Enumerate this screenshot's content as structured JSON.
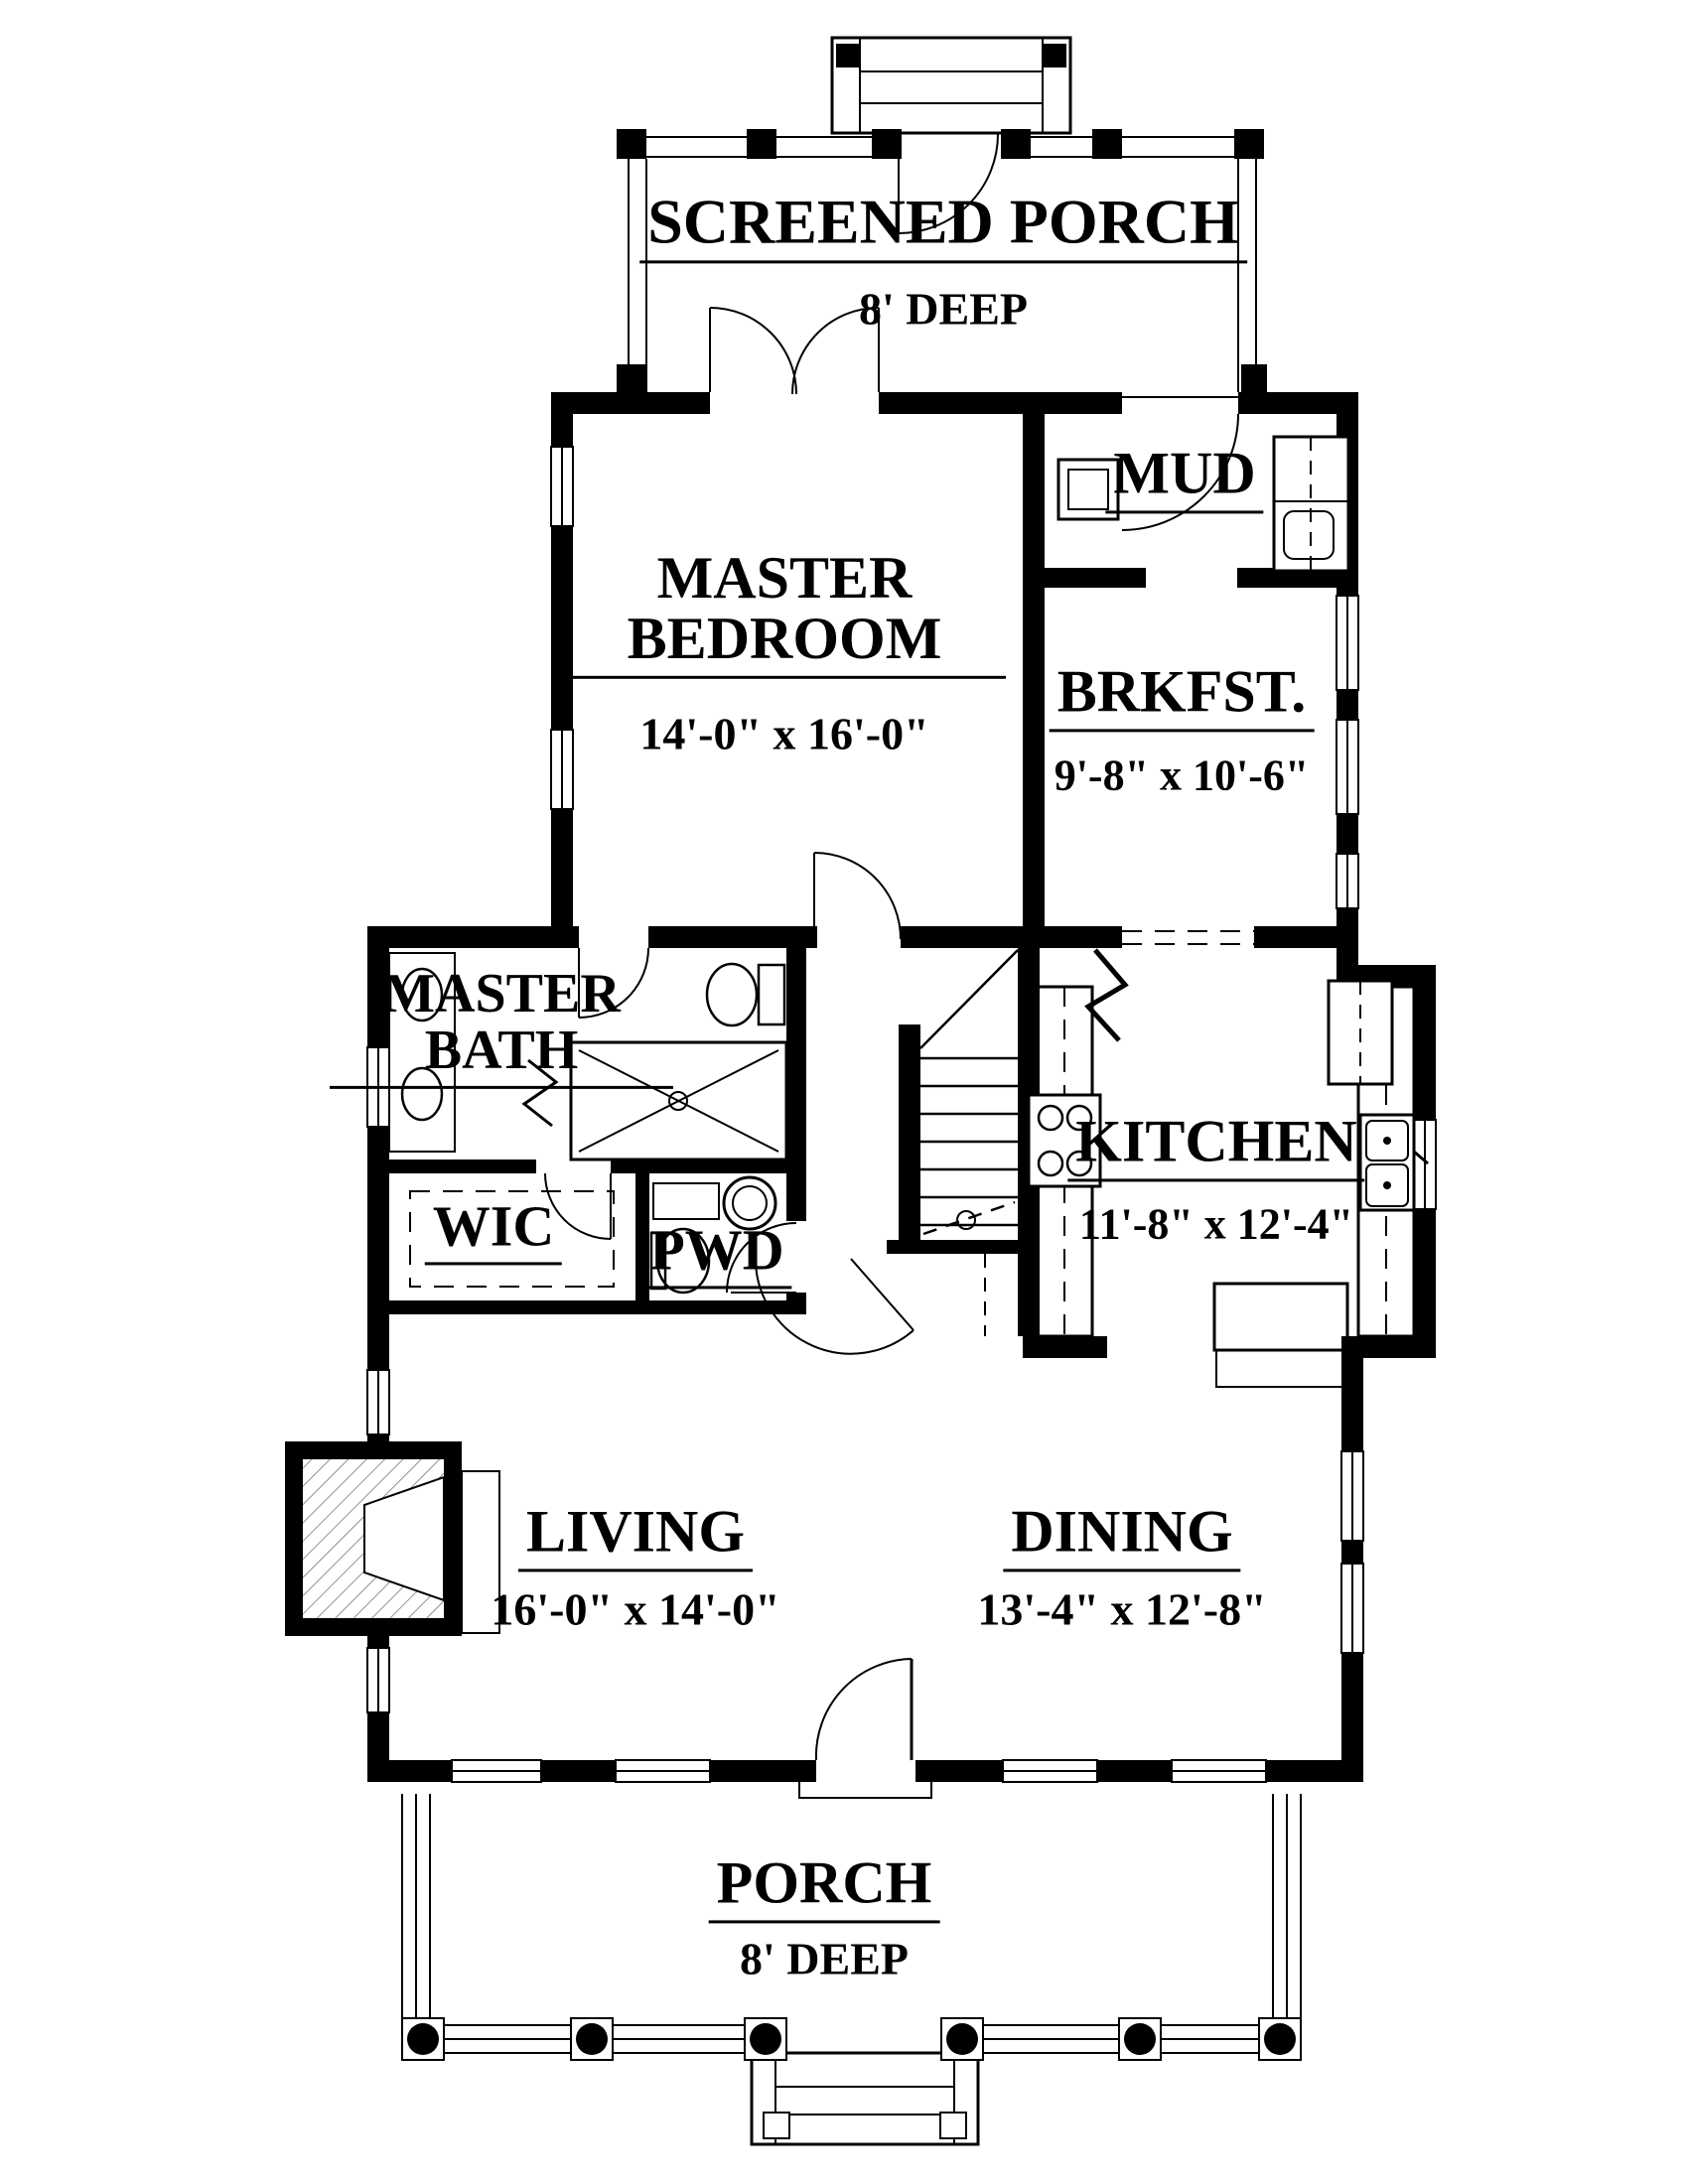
{
  "drawing": {
    "type": "first-floor plan",
    "ink_color": "#000000",
    "paper_color": "#ffffff"
  },
  "rooms": {
    "screened_porch": {
      "name": "SCREENED PORCH",
      "dims": "8' DEEP"
    },
    "mud": {
      "name": "MUD"
    },
    "master_bedroom": {
      "name": "MASTER BEDROOM",
      "dims": "14'-0\" x 16'-0\""
    },
    "brkfst": {
      "name": "BRKFST.",
      "dims": "9'-8\" x 10'-6\""
    },
    "master_bath": {
      "name": "MASTER BATH"
    },
    "wic": {
      "name": "WIC"
    },
    "pwd": {
      "name": "PWD"
    },
    "kitchen": {
      "name": "KITCHEN",
      "dims": "11'-8\" x 12'-4\""
    },
    "living": {
      "name": "LIVING",
      "dims": "16'-0\" x 14'-0\""
    },
    "dining": {
      "name": "DINING",
      "dims": "13'-4\" x 12'-8\""
    },
    "porch": {
      "name": "PORCH",
      "dims": "8' DEEP"
    }
  }
}
